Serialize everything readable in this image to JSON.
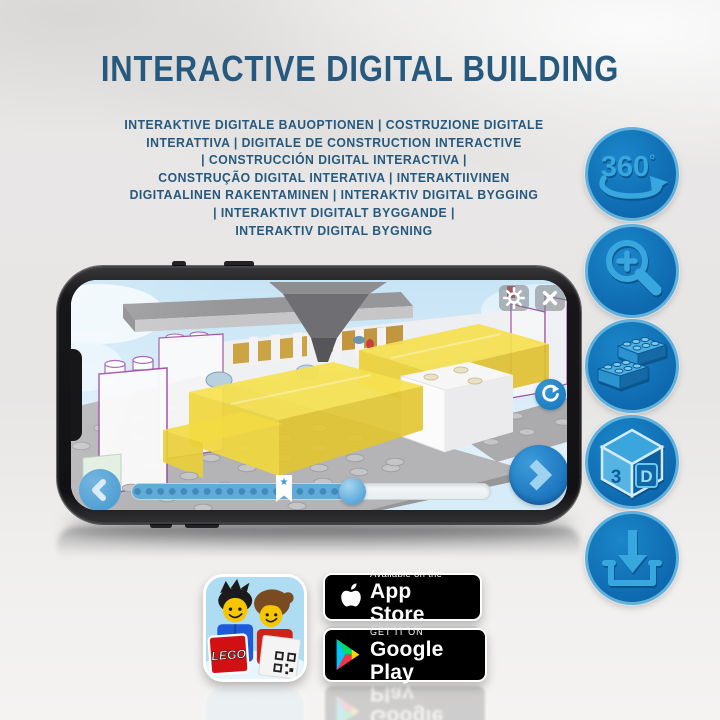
{
  "header": {
    "title": "INTERACTIVE DIGITAL BUILDING"
  },
  "subtitle": {
    "lines": [
      "INTERAKTIVE DIGITALE BAUOPTIONEN | COSTRUZIONE DIGITALE",
      "INTERATTIVA | DIGITALE DE CONSTRUCTION INTERACTIVE",
      "| CONSTRUCCIÓN DIGITAL INTERACTIVA |",
      "CONSTRUÇÃO DIGITAL INTERATIVA | INTERAKTIIVINEN",
      "DIGITAALINEN RAKENTAMINEN | INTERAKTIV DIGITAL BYGGING",
      "| INTERAKTIVT DIGITALT BYGGANDE |",
      "INTERAKTIV DIGITAL BYGNING"
    ]
  },
  "feature_icons": [
    {
      "name": "rotate-360-icon",
      "number": "360",
      "degree": "°"
    },
    {
      "name": "zoom-in-icon"
    },
    {
      "name": "bricks-icon"
    },
    {
      "name": "3d-cube-icon",
      "left": "3",
      "right": "D"
    },
    {
      "name": "download-icon"
    }
  ],
  "phone_screen": {
    "toolbar_icons": [
      "gear",
      "close-x"
    ],
    "nav_icons": [
      "chevron-left",
      "rotate-arrow",
      "chevron-right"
    ],
    "marker_star": "★",
    "progress": {
      "fill_percent": 58,
      "marker_percent": 42
    }
  },
  "badges": {
    "lego_app": {
      "logo": "LEGO"
    },
    "app_store": {
      "tagline": "Available on the",
      "store": "App Store"
    },
    "google_play": {
      "tagline": "GET IT ON",
      "store": "Google Play"
    }
  },
  "colors": {
    "title_blue": "#26597d",
    "icon_circle_blue": "#0d67ad",
    "icon_glyph_blue": "#38a6df",
    "screen_sky": "#dcecf8",
    "progress_fill": "#61abd9",
    "lego_red": "#d01012",
    "badge_black": "#000000"
  }
}
